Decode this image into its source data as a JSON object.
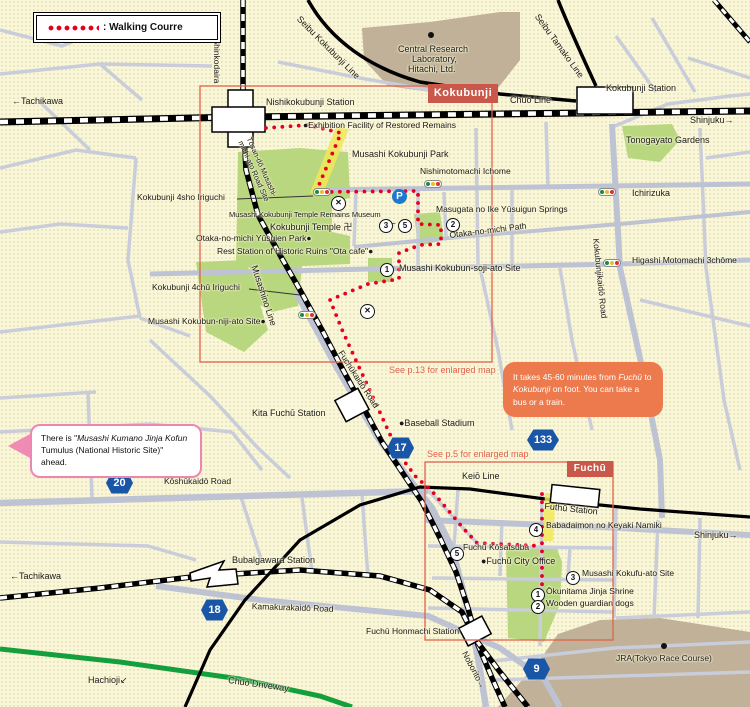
{
  "title": "Kokubunji - Fuchū walking course map",
  "colors": {
    "background": "#FAF6D8",
    "road": "#C9CDDA",
    "major_road": "#BEC3D3",
    "park_green": "#B9D77E",
    "facility_brown": "#C0B198",
    "route_red": "#E60020",
    "shield_blue": "#1A56A8",
    "region_tag_red": "#C9584A",
    "callout_orange": "#ED7A4D",
    "callout_pink_border": "#ED86B3",
    "see_note_orange": "#E2604B",
    "driveway_green": "#13A03C",
    "highlight_yellow": "#F0E758"
  },
  "legend": {
    "route_label": ": Walking Courre"
  },
  "region_tags": [
    {
      "text": "Kokubunji",
      "x": 428,
      "y": 84,
      "w": 70,
      "h": 19
    },
    {
      "text": "Fuchū",
      "x": 567,
      "y": 461,
      "w": 46,
      "h": 16
    }
  ],
  "callouts": {
    "duration": {
      "pre": "It takes 45-60 minutes from ",
      "em1": "Fuchū",
      "mid": " to ",
      "em2": "Kokubunji",
      "post": " on foot. You can take a bus or a train."
    },
    "kofun": {
      "pre": "There is \"",
      "em": "Musashi Kumano Jinja Kofun",
      "post": " Tumulus (National Historic Site)\" ahead."
    }
  },
  "map_labels": [
    {
      "name": "label-tachikawa-top",
      "text": "←Tachikawa",
      "x": 12,
      "y": 96,
      "size": 9
    },
    {
      "name": "label-shinkodaira",
      "text": "→Shinkodaira",
      "x": 221,
      "y": 30,
      "size": 8.5,
      "rot": 90
    },
    {
      "name": "label-seibu-kokubunji-line",
      "text": "Seibu Kokubunji Line",
      "x": 302,
      "y": 14,
      "size": 9,
      "rot": 45
    },
    {
      "name": "label-central-lab-1",
      "text": "Central Research",
      "x": 398,
      "y": 44,
      "size": 9
    },
    {
      "name": "label-central-lab-2",
      "text": "Laboratory,",
      "x": 412,
      "y": 54,
      "size": 9
    },
    {
      "name": "label-central-lab-3",
      "text": "Hitachi, Ltd.",
      "x": 408,
      "y": 64,
      "size": 9
    },
    {
      "name": "label-seibu-tamako-line",
      "text": "Seibu Tamako Line",
      "x": 541,
      "y": 12,
      "size": 9,
      "rot": 54
    },
    {
      "name": "label-chuo-line",
      "text": "Chūō Line",
      "x": 510,
      "y": 95,
      "size": 9
    },
    {
      "name": "label-kokubunji-station",
      "text": "Kokubunji Station",
      "x": 606,
      "y": 83,
      "size": 9
    },
    {
      "name": "label-shinjuku-top",
      "text": "Shinjuku→",
      "x": 690,
      "y": 115,
      "size": 9
    },
    {
      "name": "label-nishikokubunji-station",
      "text": "Nishikokubunji Station",
      "x": 266,
      "y": 97,
      "size": 9
    },
    {
      "name": "label-exhibition-facility",
      "text": "●Exhibition Facility of Restored Remains",
      "x": 303,
      "y": 121,
      "size": 8.5
    },
    {
      "name": "label-tosando-road-site",
      "text": "Tōsan-dō Musashi-michi-ato Road Site",
      "x": 252,
      "y": 136,
      "size": 7.5,
      "rot": 66,
      "w": 66
    },
    {
      "name": "label-musashi-kokubunji-park",
      "text": "Musashi Kokubunji Park",
      "x": 352,
      "y": 149,
      "size": 9
    },
    {
      "name": "label-nishimotomachi-ichome",
      "text": "Nishimotomachi Ichome",
      "x": 420,
      "y": 167,
      "size": 8.5
    },
    {
      "name": "label-kokubunji-4sho-iriguchi",
      "text": "Kokubunji 4sho Iriguchi",
      "x": 137,
      "y": 193,
      "size": 8.5
    },
    {
      "name": "label-temple-remains-museum",
      "text": "Musashi Kokubunji Temple Remains Museum",
      "x": 229,
      "y": 211,
      "size": 7.5
    },
    {
      "name": "label-kokubunji-temple",
      "text": "Kokubunji Temple 卍",
      "x": 270,
      "y": 222,
      "size": 9
    },
    {
      "name": "label-tilde",
      "text": "~",
      "x": 390,
      "y": 219,
      "size": 10
    },
    {
      "name": "label-yusuien-park",
      "text": "Otaka-no-michi Yūsuien Park●",
      "x": 196,
      "y": 234,
      "size": 8.5
    },
    {
      "name": "label-ota-cafe",
      "text": "Rest Station of Historic Ruins \"Ota cafe\"●",
      "x": 217,
      "y": 247,
      "size": 8.5
    },
    {
      "name": "label-masugata-springs",
      "text": "Masugata no Ike Yūsuigun Springs",
      "x": 436,
      "y": 205,
      "size": 8.5
    },
    {
      "name": "label-otaka-no-michi-path",
      "text": "Otaka-no-michi Path",
      "x": 449,
      "y": 231,
      "size": 8.5,
      "rot": -7
    },
    {
      "name": "label-kokubun-soji-ato",
      "text": "Musashi Kokubun-soji-ato Site",
      "x": 399,
      "y": 263,
      "size": 9
    },
    {
      "name": "label-kokubunji-4chu-iriguchi",
      "text": "Kokubunji 4chū Iriguchi",
      "x": 152,
      "y": 283,
      "size": 8.5
    },
    {
      "name": "label-kokubun-niji-ato",
      "text": "Musashi Kokubun-niji-ato Site●",
      "x": 148,
      "y": 317,
      "size": 8.5
    },
    {
      "name": "label-musashino-line",
      "text": "Musashino Line",
      "x": 259,
      "y": 264,
      "size": 9,
      "rot": 72
    },
    {
      "name": "label-tonogayato-gardens",
      "text": "Tonogayato Gardens",
      "x": 626,
      "y": 135,
      "size": 9
    },
    {
      "name": "label-ichirizuka",
      "text": "Ichirizuka",
      "x": 632,
      "y": 188,
      "size": 9
    },
    {
      "name": "label-higashi-motomachi",
      "text": "Higashi Motomachi 3chōme",
      "x": 632,
      "y": 256,
      "size": 8.5
    },
    {
      "name": "label-kokubunjikaido-road",
      "text": "Kokubunjikaidō Road",
      "x": 600,
      "y": 238,
      "size": 8.5,
      "rot": 84
    },
    {
      "name": "label-see-p13",
      "text": "See p.13 for enlarged map",
      "x": 389,
      "y": 365,
      "size": 9,
      "color": "#E2604B"
    },
    {
      "name": "label-kita-fuchu-station",
      "text": "Kita Fuchū Station",
      "x": 252,
      "y": 408,
      "size": 9
    },
    {
      "name": "label-fuchukaido-road",
      "text": "Fuchūkaidō Road",
      "x": 344,
      "y": 349,
      "size": 8.5,
      "rot": 57
    },
    {
      "name": "label-baseball-stadium",
      "text": "●Baseball Stadium",
      "x": 399,
      "y": 418,
      "size": 9
    },
    {
      "name": "label-see-p5",
      "text": "See p.5 for enlarged map",
      "x": 427,
      "y": 449,
      "size": 9,
      "color": "#E2604B"
    },
    {
      "name": "label-keio-line",
      "text": "Keiō Line",
      "x": 462,
      "y": 471,
      "size": 9
    },
    {
      "name": "label-futhu-station",
      "text": "Futhū Station",
      "x": 545,
      "y": 501,
      "size": 9,
      "rot": 6
    },
    {
      "name": "label-babadaimon-keyaki",
      "text": "Babadaimon no Keyaki Namiki",
      "x": 546,
      "y": 521,
      "size": 8.5
    },
    {
      "name": "label-shinjuku-fuchu",
      "text": "Shinjuku→",
      "x": 694,
      "y": 530,
      "size": 9
    },
    {
      "name": "label-fuchu-kosatsuba",
      "text": "Fuchū Kōsatsuba",
      "x": 463,
      "y": 543,
      "size": 8.5
    },
    {
      "name": "label-fuchu-city-office",
      "text": "●Fuchū City Office",
      "x": 481,
      "y": 556,
      "size": 9
    },
    {
      "name": "label-musashi-kokufu-ato",
      "text": "Musashi Kokufu-ato Site",
      "x": 582,
      "y": 569,
      "size": 8.5
    },
    {
      "name": "label-okunitama-shrine",
      "text": "Ōkunitama Jinja Shrine",
      "x": 546,
      "y": 587,
      "size": 8.5
    },
    {
      "name": "label-wooden-guardian-dogs",
      "text": "Wooden guardian dogs",
      "x": 546,
      "y": 599,
      "size": 8.5
    },
    {
      "name": "label-koshukaido-road",
      "text": "Kōshūkaidō Road",
      "x": 164,
      "y": 477,
      "size": 8.5
    },
    {
      "name": "label-tachikawa-mid",
      "text": "←Tachikawa",
      "x": 10,
      "y": 571,
      "size": 9
    },
    {
      "name": "label-bubaigawara-station",
      "text": "Bubalgawara Station",
      "x": 232,
      "y": 555,
      "size": 9
    },
    {
      "name": "label-kamakurakaido-road",
      "text": "Kamakurakaidō Road",
      "x": 252,
      "y": 602,
      "size": 8.5,
      "rot": 2
    },
    {
      "name": "label-fuchu-honmachi-station",
      "text": "Fuchū Honmachi Station",
      "x": 366,
      "y": 627,
      "size": 8.5
    },
    {
      "name": "label-noborito",
      "text": "Noborito→",
      "x": 468,
      "y": 650,
      "size": 8.5,
      "rot": 62
    },
    {
      "name": "label-jra",
      "text": "JRA(Tokyo Race Course)",
      "x": 616,
      "y": 654,
      "size": 8.5
    },
    {
      "name": "label-hachioji",
      "text": "Hachioji↙",
      "x": 88,
      "y": 675,
      "size": 9
    },
    {
      "name": "label-chuo-driveway",
      "text": "Chūō Driveway",
      "x": 229,
      "y": 675,
      "size": 9,
      "rot": 8
    }
  ],
  "route_shields": [
    {
      "num": "20",
      "x": 106,
      "y": 471,
      "w": 27
    },
    {
      "num": "17",
      "x": 387,
      "y": 436,
      "w": 27
    },
    {
      "num": "133",
      "x": 527,
      "y": 428,
      "w": 32
    },
    {
      "num": "18",
      "x": 201,
      "y": 598,
      "w": 27
    },
    {
      "num": "9",
      "x": 523,
      "y": 657,
      "w": 27
    }
  ],
  "poi_markers": [
    {
      "n": "3",
      "x": 379,
      "y": 219
    },
    {
      "n": "5",
      "x": 398,
      "y": 219
    },
    {
      "n": "2",
      "x": 446,
      "y": 218
    },
    {
      "n": "1",
      "x": 380,
      "y": 263
    },
    {
      "n": "4",
      "x": 529,
      "y": 523
    },
    {
      "n": "5",
      "x": 450,
      "y": 547
    },
    {
      "n": "3",
      "x": 566,
      "y": 571
    },
    {
      "n": "1",
      "x": 531,
      "y": 588
    },
    {
      "n": "2",
      "x": 531,
      "y": 600
    }
  ],
  "traffic_lights": [
    {
      "x": 313,
      "y": 188
    },
    {
      "x": 424,
      "y": 180
    },
    {
      "x": 598,
      "y": 188
    },
    {
      "x": 603,
      "y": 259
    },
    {
      "x": 298,
      "y": 311
    }
  ],
  "police_icons": [
    {
      "x": 331,
      "y": 196
    },
    {
      "x": 360,
      "y": 304
    }
  ],
  "parking_icons": [
    {
      "x": 392,
      "y": 189
    }
  ],
  "poi_dots": [
    {
      "x": 428,
      "y": 32
    },
    {
      "x": 661,
      "y": 643
    }
  ],
  "traffic_light_colors": [
    "#1C8C3C",
    "#E8C020",
    "#E03030"
  ]
}
